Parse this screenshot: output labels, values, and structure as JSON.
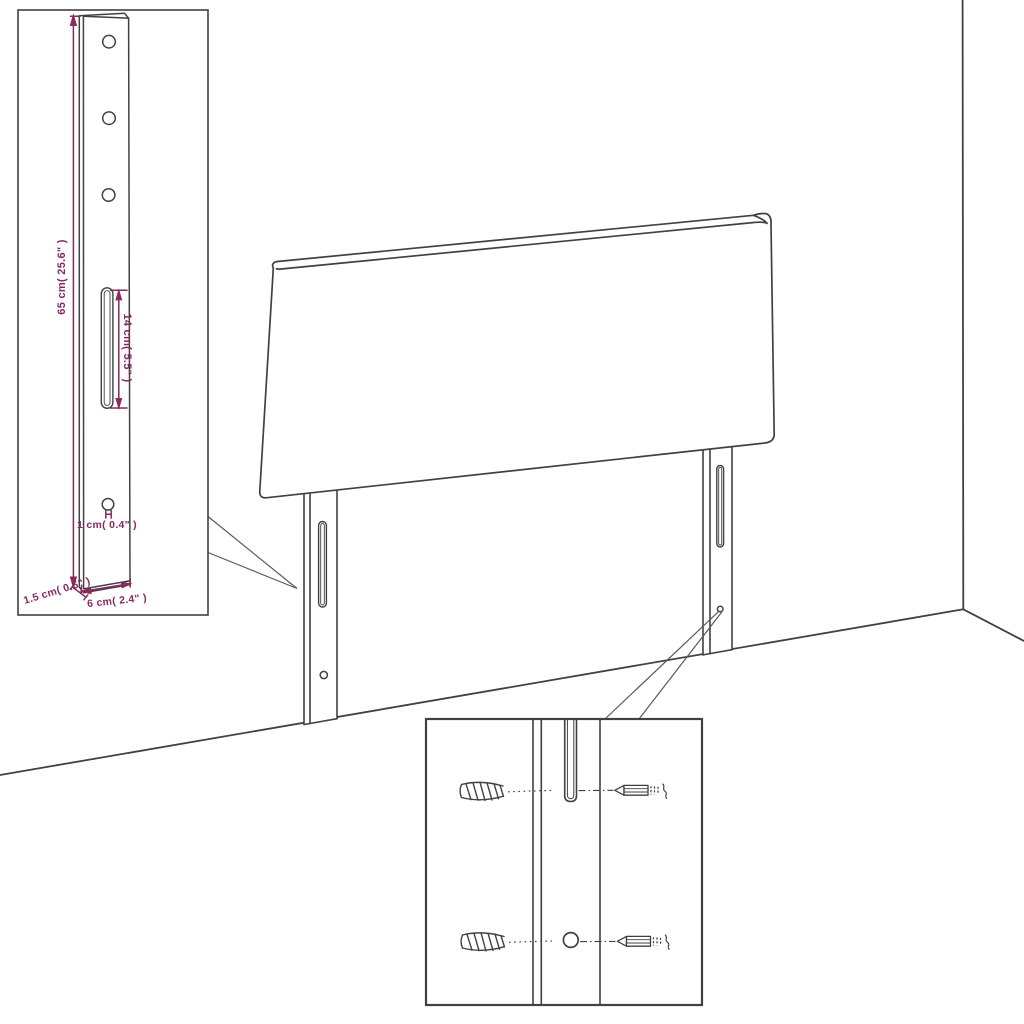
{
  "diagram": {
    "type": "product-assembly-line-drawing",
    "subject": "headboard with two mounting legs in a room corner",
    "labels": {
      "leg_height": "65 cm( 25.6\" )",
      "slot_length": "14 cm( 5.5\" )",
      "hole_diameter": "1 cm( 0.4\" )",
      "leg_thickness": "1.5 cm( 0.6\" )",
      "leg_width": "6 cm( 2.4\" )"
    },
    "colors": {
      "background": "#ffffff",
      "line": "#414141",
      "dimension": "#862a60",
      "callout": "#5a5a5a"
    },
    "parts": [
      "headboard-panel",
      "left-mounting-leg",
      "right-mounting-leg",
      "wall-corner",
      "floor-line",
      "leg-dimension-inset",
      "mounting-hardware-inset",
      "wall-anchor",
      "screw"
    ]
  }
}
